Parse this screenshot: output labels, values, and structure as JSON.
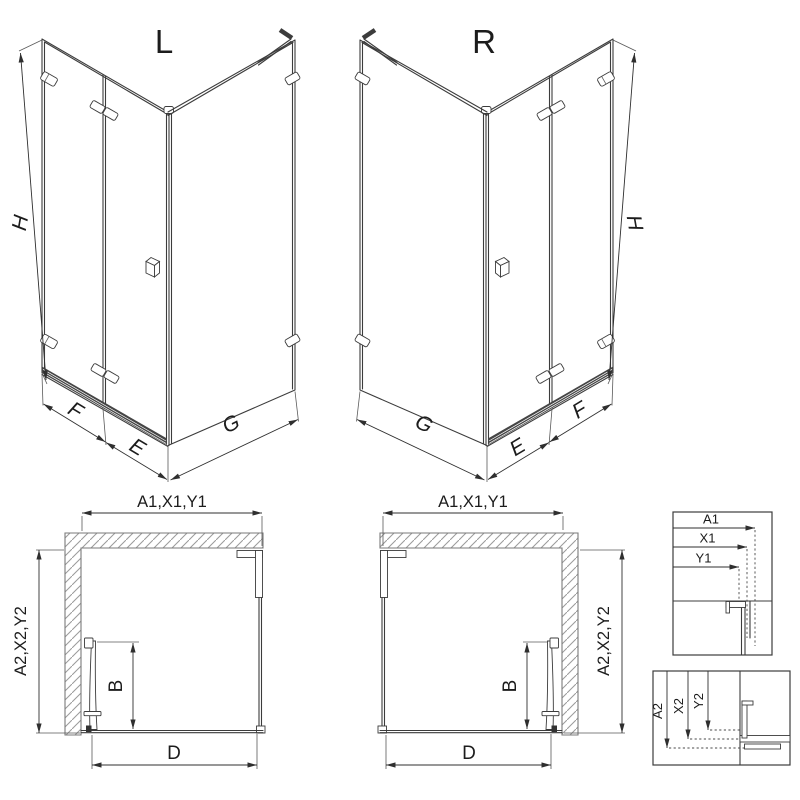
{
  "colors": {
    "line": "#3c3c3c",
    "dimension": "#2f2f2f",
    "hatch": "#9a9a9a",
    "rail": "#454545",
    "background": "#ffffff"
  },
  "iso_left": {
    "label": "L",
    "dim_h": "H",
    "dim_f": "F",
    "dim_e": "E",
    "dim_g": "G"
  },
  "iso_right": {
    "label": "R",
    "dim_h": "H",
    "dim_f": "F",
    "dim_e": "E",
    "dim_g": "G"
  },
  "plan_left": {
    "dim_top": "A1,X1,Y1",
    "dim_side": "A2,X2,Y2",
    "dim_door": "B",
    "dim_opening": "D"
  },
  "plan_right": {
    "dim_top": "A1,X1,Y1",
    "dim_side": "A2,X2,Y2",
    "dim_door": "B",
    "dim_opening": "D"
  },
  "detail_top": {
    "row1": "A1",
    "row2": "X1",
    "row3": "Y1"
  },
  "detail_bottom": {
    "col1": "A2",
    "col2": "X2",
    "col3": "Y2"
  }
}
